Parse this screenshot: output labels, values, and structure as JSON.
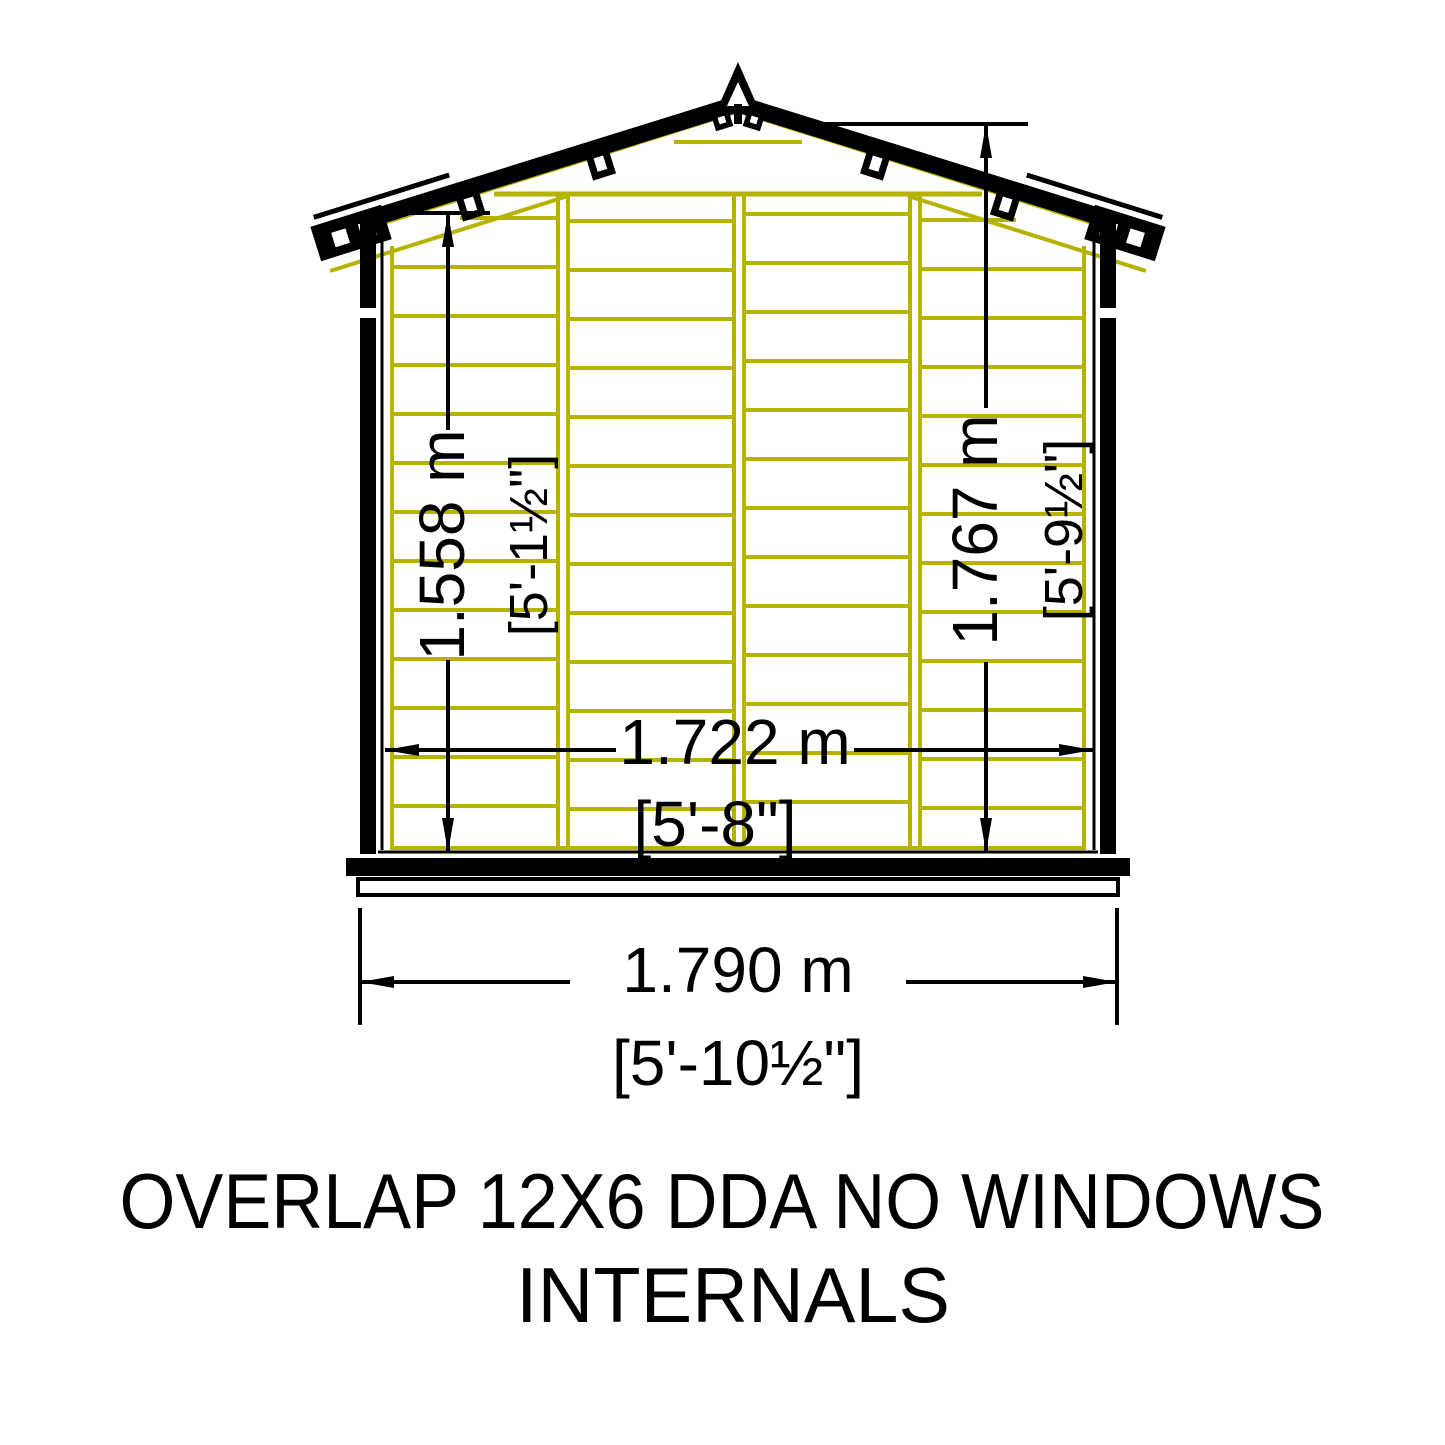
{
  "title": {
    "line1": "OVERLAP 12X6 DDA NO WINDOWS",
    "line2": "INTERNALS"
  },
  "drawing": {
    "name": "shed-gable-end-internal-elevation",
    "colors": {
      "timber_frame": "#b5b300",
      "outline": "#000000",
      "background": "#ffffff"
    },
    "dimensions": {
      "eaves_height": {
        "metric": "1.558 m",
        "imperial": "[5'-1½\"]"
      },
      "ridge_height": {
        "metric": "1.767 m",
        "imperial": "[5'-9½\"]"
      },
      "internal_width": {
        "metric": "1.722 m",
        "imperial": "[5'-8\"]"
      },
      "overall_width": {
        "metric": "1.790 m",
        "imperial": "[5'-10½\"]"
      }
    }
  }
}
